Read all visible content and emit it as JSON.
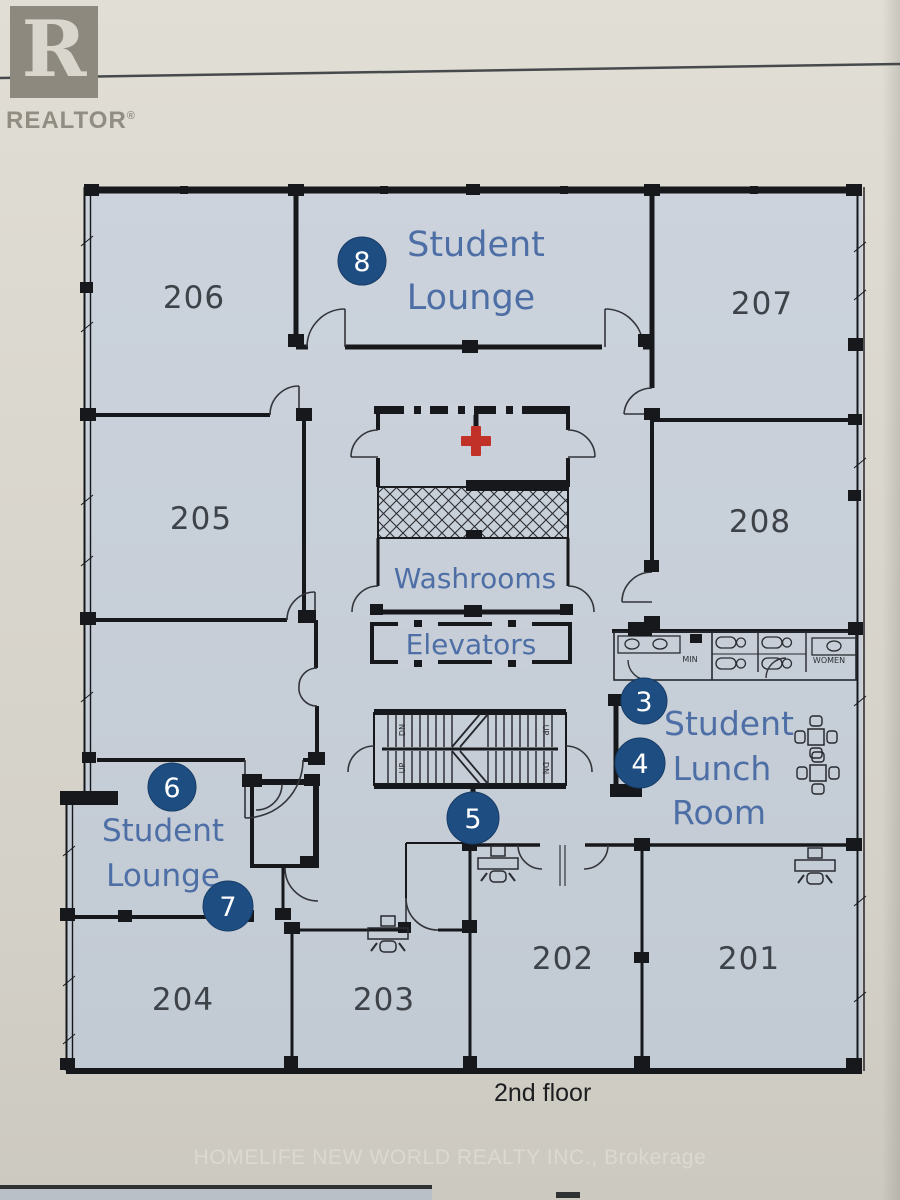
{
  "branding": {
    "logo_letter": "R",
    "logo_word": "REALTOR",
    "registered_mark": "®"
  },
  "plan": {
    "floor_label": "2nd floor",
    "rooms": {
      "201": "201",
      "202": "202",
      "203": "203",
      "204": "204",
      "205": "205",
      "206": "206",
      "207": "207",
      "208": "208"
    },
    "labels": {
      "lounge_top_line1": "Student",
      "lounge_top_line2": "Lounge",
      "washrooms": "Washrooms",
      "elevators": "Elevators",
      "lunch_line1": "Student",
      "lunch_line2": "Lunch",
      "lunch_line3": "Room",
      "lounge_left_line1": "Student",
      "lounge_left_line2": "Lounge",
      "wc_men": "MIN",
      "wc_women": "WOMEN",
      "stair_dn": "DN",
      "stair_up": "UP"
    },
    "markers": {
      "m3": "3",
      "m4": "4",
      "m5": "5",
      "m6": "6",
      "m7": "7",
      "m8": "8"
    },
    "colors": {
      "floor_fill": "#c6ced8",
      "wall": "#17181c",
      "label_blue": "#4e6fa6",
      "marker_blue": "#1e4d82",
      "cross_red": "#c23128",
      "room_number": "#3e434a",
      "paper": "#d9d5cc"
    }
  },
  "footer": {
    "watermark": "HOMELIFE NEW WORLD REALTY INC., Brokerage"
  }
}
